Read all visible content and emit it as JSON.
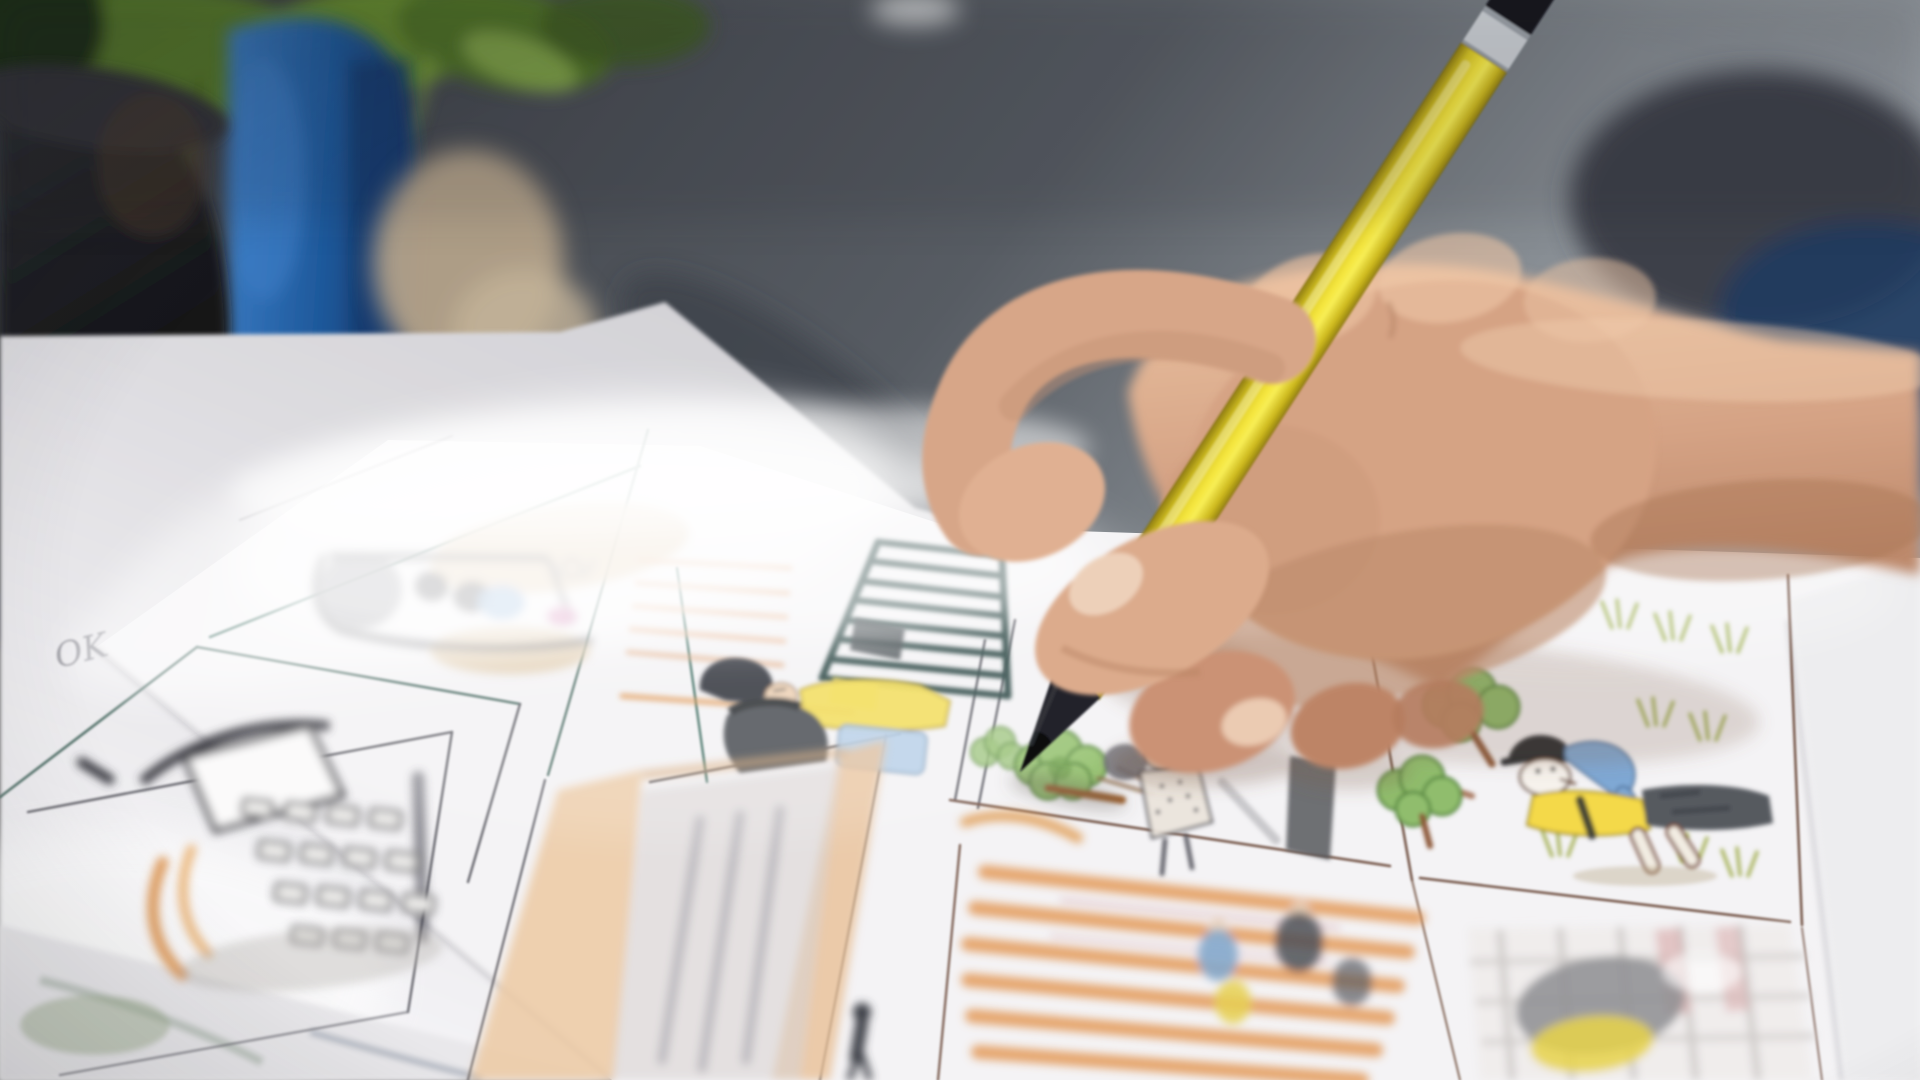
{
  "scene": {
    "title": "Storyboard artist colouring panels with a yellow pencil",
    "description": "Close-up photograph of a right hand holding a yellow pencil with a black tip, drawing on a printed storyboard sheet lying on a desk. Background is heavily blurred: a green potted plant, a dark plant pot, a blue container and a dark grey shelf/monitor slab.",
    "annotation_text": "OK"
  },
  "palette": {
    "paper": "#f4f3f5",
    "under_paper": "#e9e8eb",
    "desk": "#dcdbdf",
    "background_gray": "#55595f",
    "blue_container": "#1f5a9d",
    "plant_green": "#5f8136",
    "pot_black": "#17181b",
    "pencil_yellow": "#f0df38",
    "pencil_tip": "#1d1f24",
    "pencil_band": "#ccd0d5",
    "pencil_end": "#17181c",
    "skin": "#d2a084",
    "skin_light": "#ecc3a2",
    "skin_shadow": "#b07b5e",
    "sketch_line": "#5a5a62",
    "sketch_teal": "#2e4a46",
    "accent_orange": "#e2934e",
    "accent_yellow": "#f4d94a",
    "accent_blue": "#7fa8d4",
    "accent_green": "#8cba68"
  },
  "sheet": {
    "annotation": "OK",
    "panels": [
      {
        "id": "cart-scene",
        "description": "Hazy sketch of children riding a small cart, grey outlines with blue and pink accents and tan wash"
      },
      {
        "id": "stairs-scene",
        "description": "Woman with black bob hair and yellow top beside a dark teal ladder-like staircase, peach window blinds"
      },
      {
        "id": "park-scene",
        "description": "Green trees and a walking figure in a dotted coat; the pencil tip touches a tree"
      },
      {
        "id": "dog-character",
        "description": "Cartoon dog with dark cap, blue head patch and yellow scarf among trees and grass tufts"
      },
      {
        "id": "empty-panel",
        "description": "Blank storyboard panel"
      },
      {
        "id": "phone-device",
        "description": "Tilted handheld device with white screen, keypad grid and orange arcs"
      },
      {
        "id": "corridor",
        "description": "Hallway with warm orange walls, pencil-shaded floor and a small walking figure"
      },
      {
        "id": "crosswalk",
        "description": "Orange striped crosswalk with small blue, yellow and grey figures"
      },
      {
        "id": "storefront",
        "description": "Blurred shelf grid with grey and yellow shapes and pink bands"
      }
    ]
  },
  "pencil": {
    "type": "colour pencil",
    "body": "yellow",
    "tip": "black graphite cone",
    "band": "silver ring",
    "end": "black painted cap"
  },
  "hand": {
    "side": "right",
    "grip": "tripod grip, fingers curled, resting on the sheet"
  }
}
